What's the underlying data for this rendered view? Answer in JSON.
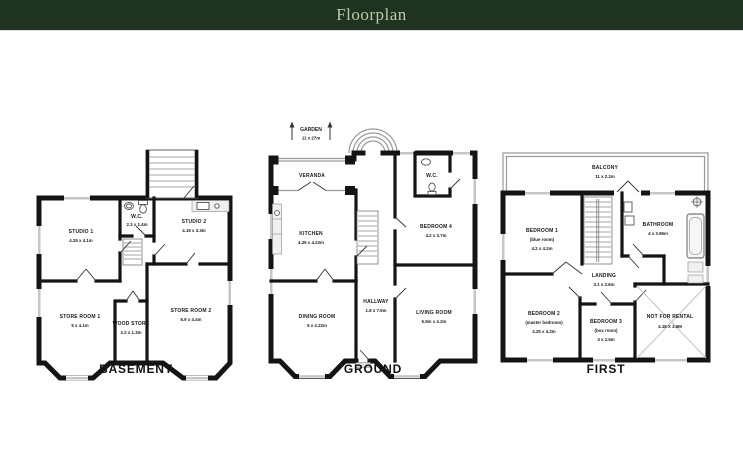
{
  "header": {
    "title": "Floorplan"
  },
  "floor_labels": {
    "basement": "BASEMENT",
    "ground": "GROUND",
    "first": "FIRST"
  },
  "basement": {
    "studio1": {
      "name": "STUDIO 1",
      "dims": "4.25 x 4.1m"
    },
    "wc": {
      "name": "W.C.",
      "dims": "2.3 x 1.4m"
    },
    "studio2": {
      "name": "STUDIO 2",
      "dims": "4.15 x 3.3m"
    },
    "store1": {
      "name": "STORE ROOM 1",
      "dims": "5 x 4.1m"
    },
    "woodstore": {
      "name": "WOOD STORE",
      "dims": "2.2 x 1.3m"
    },
    "store2": {
      "name": "STORE ROOM 2",
      "dims": "5.9 x 4.4m"
    }
  },
  "ground": {
    "garden": {
      "name": "GARDEN",
      "dims": "11 x 27m"
    },
    "veranda": {
      "name": "VERANDA"
    },
    "wc": {
      "name": "W.C."
    },
    "kitchen": {
      "name": "KITCHEN",
      "dims": "4.25 x 4.22m"
    },
    "bedroom4": {
      "name": "BEDROOM 4",
      "dims": "4.2 x 3.7m"
    },
    "hallway": {
      "name": "HALLWAY",
      "dims": "1.8 x 7.5m"
    },
    "dining": {
      "name": "DINING ROOM",
      "dims": "5 x 4.22m"
    },
    "living": {
      "name": "LIVING ROOM",
      "dims": "5.9m x 4.2m"
    }
  },
  "first": {
    "balcony": {
      "name": "BALCONY",
      "dims": "11 x 2.2m"
    },
    "bedroom1": {
      "name": "BEDROOM 1",
      "sub": "(blue room)",
      "dims": "4.2 x 4.2m"
    },
    "bathroom": {
      "name": "BATHROOM",
      "dims": "4 x 3.95m"
    },
    "landing": {
      "name": "LANDING",
      "dims": "3.1 x 2.6m"
    },
    "bedroom2": {
      "name": "BEDROOM 2",
      "sub": "(master bedroom)",
      "dims": "4.25 x 4.2m"
    },
    "bedroom3": {
      "name": "BEDROOM 3",
      "sub": "(box room)",
      "dims": "3 x 2.5m"
    },
    "notforrental": {
      "name": "NOT FOR RENTAL",
      "dims": "4.18 X 3.6M"
    }
  }
}
